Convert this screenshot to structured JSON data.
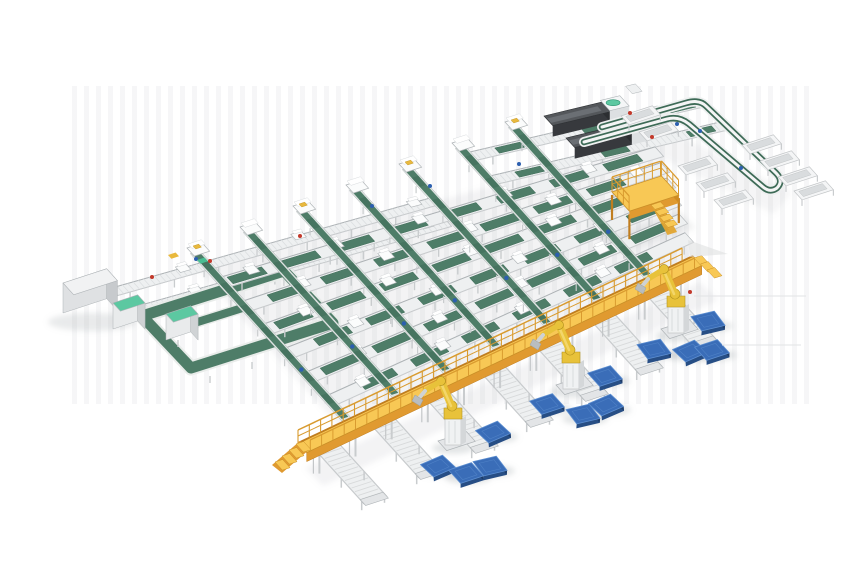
{
  "page": {
    "background": "#ffffff",
    "description": "Isometric 3D render of an automated parcel sorting and robotic palletizing system on a white background"
  },
  "colors": {
    "frame_light": "#eef0f1",
    "frame_mid": "#c9ccce",
    "frame_line": "#aeb3b6",
    "frame_dark": "#8f9497",
    "belt": "#4e7d68",
    "belt_dark": "#3e6b57",
    "belt_edge": "#dfe5e2",
    "mint": "#5cc8a1",
    "mint_dark": "#2f9371",
    "walk_top": "#f8c855",
    "walk_face": "#e09a30",
    "walk_deep": "#c07d1f",
    "walk_rail": "#d99b2f",
    "walk_edge": "#c98f27",
    "robot": "#e8c23a",
    "robot_dark": "#b4931f",
    "pallet": "#3a6db8",
    "pallet_dark": "#274e85",
    "pallet_deep": "#1d3c69",
    "pallet_light": "#5d8fd1",
    "machine_top": "#54575b",
    "machine_front": "#37393d",
    "machine_ridge": "#6b6f74",
    "white_box": "#fbfcfc",
    "red": "#c2392b",
    "blue": "#2c5faf",
    "shadow": "#9aa0a4",
    "stripe": "#ebecee",
    "pkg_yellow": "#e9b93d",
    "pkg_teal": "#49bd92",
    "artifact": "#e2e3e5"
  },
  "equipment": [
    {
      "name": "infeed-machine",
      "count": 1
    },
    {
      "name": "infeed-conveyor-lines",
      "count": 2
    },
    {
      "name": "tote-return-loop",
      "count": 1
    },
    {
      "name": "control-cabinets",
      "count": 2
    },
    {
      "name": "sorter-lines",
      "count": 7
    },
    {
      "name": "induction-stations",
      "count": 7
    },
    {
      "name": "cross-transport-lines",
      "count": 6
    },
    {
      "name": "strapping-machines",
      "count": 2
    },
    {
      "name": "maintenance-platform",
      "count": 1
    },
    {
      "name": "discharge-loop-conveyor",
      "count": 1
    },
    {
      "name": "discharge-trays",
      "count": 9
    },
    {
      "name": "elevated-walkway",
      "count": 1
    },
    {
      "name": "palletizing-robots",
      "count": 3
    },
    {
      "name": "outfeed-spur-conveyors",
      "count": 7
    },
    {
      "name": "pallets",
      "count": 12
    }
  ],
  "scene": {
    "canvas": {
      "width": 860,
      "height": 580
    },
    "walkway": {
      "x1": 298,
      "y1": 443,
      "x2": 693,
      "y2": 256,
      "deck_width": 13
    },
    "walkway_stairs_left": [
      296,
      444
    ],
    "walkway_ramp_right": [
      694,
      258
    ],
    "alines": [
      [
        218,
        278,
        -0.3,
        655
      ],
      [
        240,
        302,
        -0.331,
        661
      ],
      [
        261,
        325,
        -0.362,
        667
      ],
      [
        283,
        349,
        -0.393,
        673
      ],
      [
        304,
        373,
        -0.424,
        679
      ],
      [
        326,
        396,
        -0.455,
        685
      ]
    ],
    "blines": [
      [
        195,
        252,
        347,
        420
      ],
      [
        248,
        231,
        397,
        396
      ],
      [
        301,
        210,
        448,
        372
      ],
      [
        354,
        189,
        498,
        348
      ],
      [
        407,
        168,
        549,
        325
      ],
      [
        460,
        147,
        599,
        301
      ],
      [
        513,
        126,
        649,
        277
      ]
    ],
    "infeed_lines": [
      [
        108,
        289,
        430,
        198
      ],
      [
        120,
        311,
        445,
        219
      ]
    ],
    "machine_lines": [
      [
        470,
        152,
        700,
        98
      ],
      [
        490,
        176,
        720,
        122
      ]
    ],
    "machines": [
      [
        544,
        116
      ],
      [
        566,
        138
      ]
    ],
    "infeed_box": {
      "x": 63,
      "y": 283
    },
    "cabinets": [
      [
        113,
        303
      ],
      [
        166,
        314
      ]
    ],
    "return_loop": [
      [
        142,
        316
      ],
      [
        284,
        271
      ],
      [
        333,
        323
      ],
      [
        191,
        368
      ]
    ],
    "loop_branch": [
      172,
      330,
      252,
      305
    ],
    "top_loop_path": "M 602 127 L 686 103 Q 699 99 706 106 L 776 173 Q 784 181 777 188 Q 770 193 763 187 L 689 124 Q 679 116 667 119 L 584 142",
    "trays": [
      [
        637,
        111
      ],
      [
        655,
        127
      ],
      [
        694,
        161
      ],
      [
        712,
        178
      ],
      [
        730,
        195
      ],
      [
        758,
        140
      ],
      [
        776,
        156
      ],
      [
        794,
        172
      ],
      [
        810,
        186
      ]
    ],
    "mezzanine": {
      "x": 612,
      "y": 170
    },
    "spur_x": [
      316,
      371,
      426,
      481,
      536,
      591,
      646
    ],
    "robots": [
      [
        453,
        437
      ],
      [
        571,
        381
      ],
      [
        676,
        325
      ]
    ],
    "pallets": [
      [
        438,
        466
      ],
      [
        466,
        473
      ],
      [
        490,
        466
      ],
      [
        493,
        432
      ],
      [
        547,
        404
      ],
      [
        583,
        414
      ],
      [
        606,
        405
      ],
      [
        605,
        376
      ],
      [
        654,
        349
      ],
      [
        690,
        351
      ],
      [
        712,
        350
      ],
      [
        708,
        321
      ]
    ],
    "dots_red": [
      [
        152,
        277
      ],
      [
        210,
        261
      ],
      [
        300,
        236
      ],
      [
        630,
        113
      ],
      [
        652,
        137
      ],
      [
        690,
        292
      ]
    ],
    "dots_blue": [
      [
        196,
        259
      ],
      [
        372,
        206
      ],
      [
        430,
        186
      ],
      [
        519,
        164
      ],
      [
        677,
        124
      ],
      [
        700,
        131
      ],
      [
        741,
        168
      ]
    ],
    "packages": [
      [
        168,
        255,
        "pkg_yellow"
      ],
      [
        197,
        260,
        "pkg_teal"
      ]
    ],
    "artifact_lines": [
      [
        694,
        296,
        806,
        296
      ],
      [
        722,
        345,
        801,
        345
      ]
    ],
    "artifact_patch": [
      [
        688,
        240
      ],
      [
        728,
        254
      ],
      [
        690,
        257
      ]
    ]
  }
}
